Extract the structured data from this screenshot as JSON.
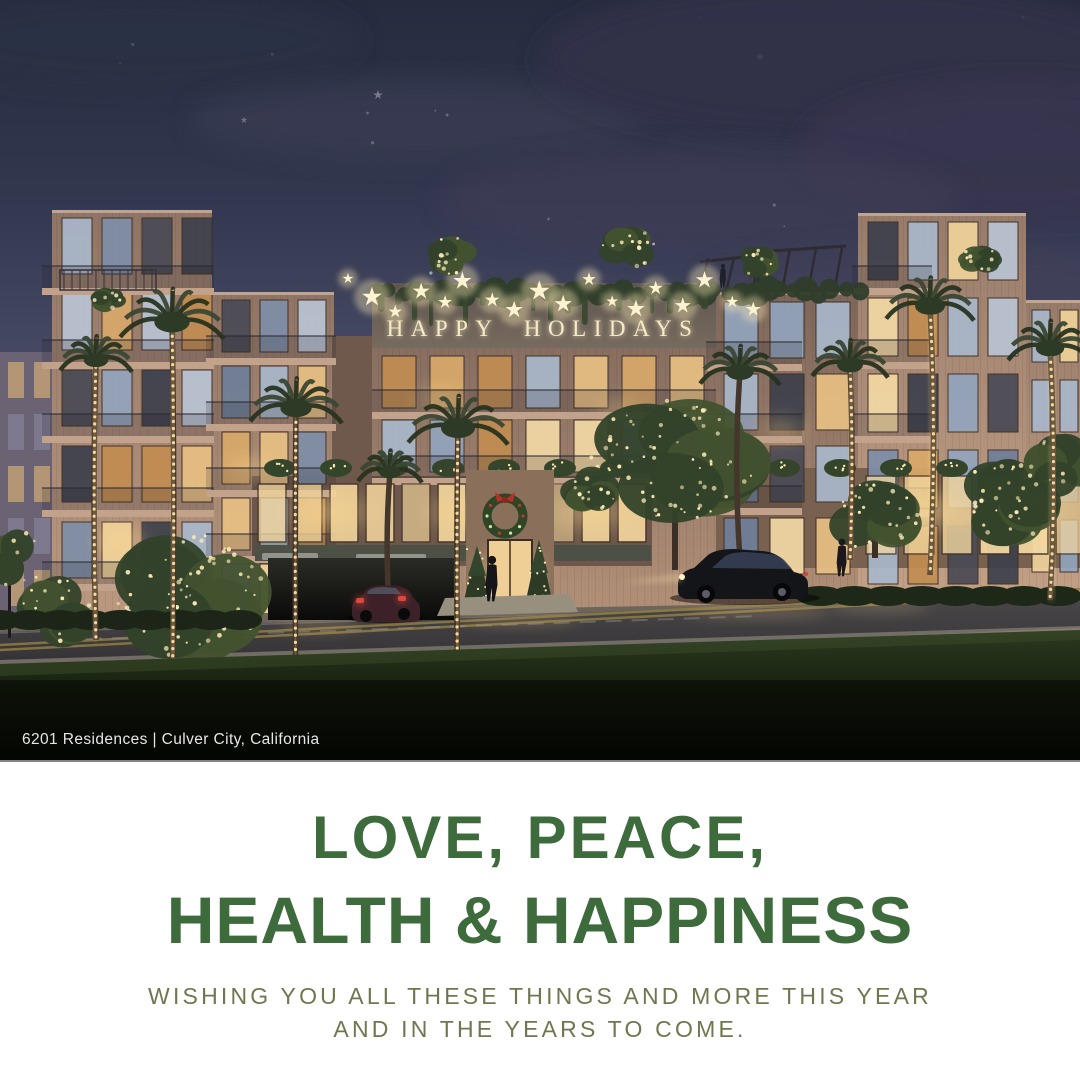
{
  "photo": {
    "sign": {
      "text": "HAPPY HOLIDAYS"
    },
    "caption": "6201 Residences | Culver City, California"
  },
  "message": {
    "heading_line1": "LOVE, PEACE,",
    "heading_line2": "HEALTH & HAPPINESS",
    "subheading_line1": "WISHING YOU ALL THESE THINGS AND MORE THIS YEAR",
    "subheading_line2": "AND IN THE YEARS TO COME."
  },
  "colors": {
    "heading_green": "#3e6b3c",
    "subheading_olive": "#6f774f",
    "sign_glow": "#f6ebc8",
    "caption_white": "#f0f0f0",
    "sky_top": "#262b3e",
    "sky_horizon": "#8d7f94",
    "background_white": "#ffffff"
  }
}
